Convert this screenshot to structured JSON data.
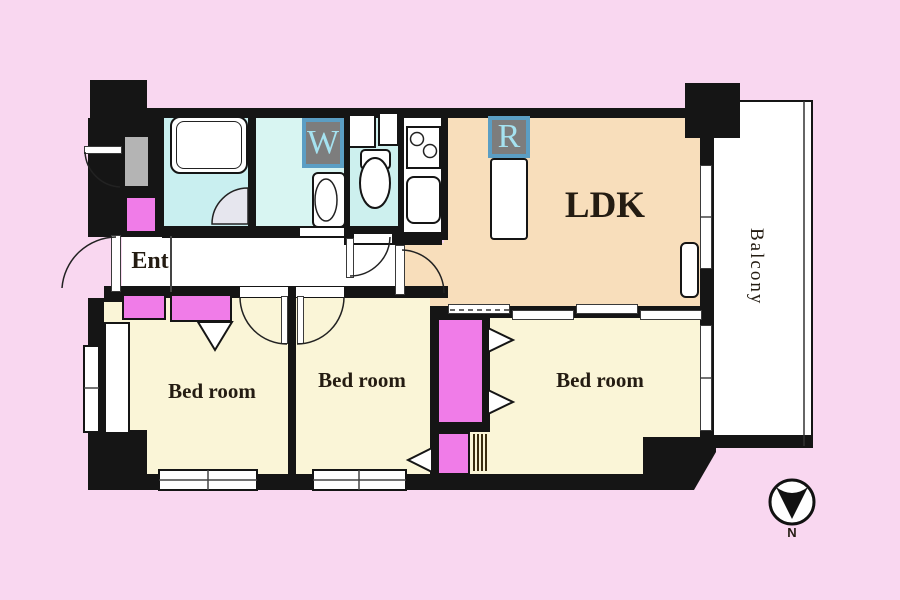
{
  "floorplan": {
    "labels": {
      "ldk": "LDK",
      "ent": "Ent",
      "bedroom1": "Bed room",
      "bedroom2": "Bed room",
      "bedroom3": "Bed room",
      "balcony": "Balcony",
      "washer": "W",
      "refrigerator": "R",
      "compass_north": "N"
    },
    "colors": {
      "background": "#f9d7f0",
      "wall": "#151515",
      "bathroom": "#c9eff0",
      "washroom": "#d8f5f2",
      "toilet": "#cdf0ee",
      "kitchen": "#ffffff",
      "ldk": "#f8debb",
      "bedroom": "#faf5d7",
      "closet": "#f07ce8",
      "hallway": "#ffffff",
      "balcony": "#ffffff",
      "gray_box": "#b4b4b4",
      "icon_frame": "#5b9ec4",
      "icon_bg": "#7d7d7d",
      "icon_letter": "#a5e2f0",
      "text": "#241c12"
    }
  }
}
